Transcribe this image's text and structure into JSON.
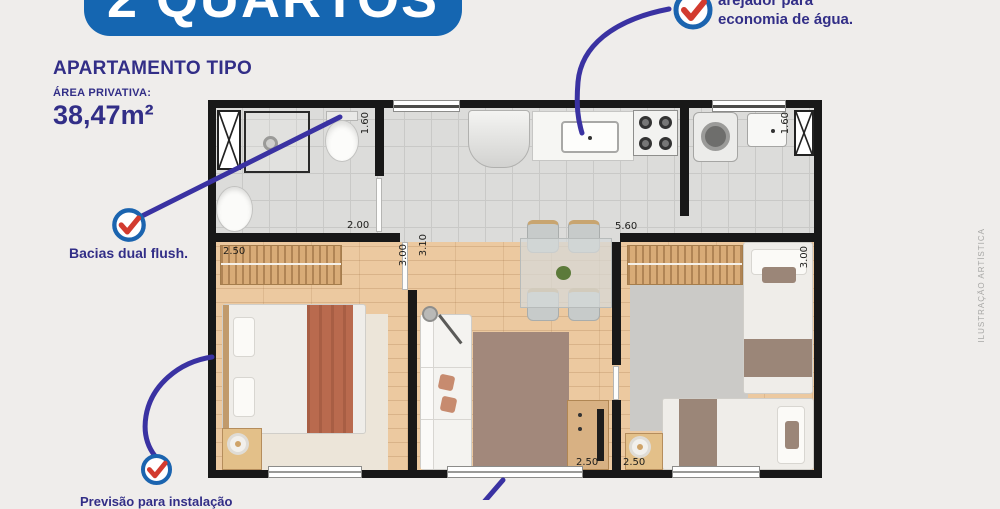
{
  "colors": {
    "brand_blue": "#1566b1",
    "text_indigo": "#322e87",
    "line_indigo": "#3a32a2",
    "check_red": "#d23b2f",
    "wall": "#181818",
    "bg": "#efedeb"
  },
  "banner": {
    "title": "2 QUARTOS"
  },
  "header": {
    "title": "APARTAMENTO TIPO",
    "area_label": "ÁREA PRIVATIVA:",
    "area_value": "38,47m²"
  },
  "callouts": {
    "water": {
      "line1": "arejador para",
      "line2": "economia de água."
    },
    "toilet": {
      "text": "Bacias dual flush."
    },
    "bottom": {
      "text": "Previsão para instalação"
    }
  },
  "watermark": {
    "text": "ILUSTRAÇÃO ARTÍSTICA"
  },
  "floorplan": {
    "dimensions": {
      "bathroom_width": "1.60",
      "bathroom_length": "2.00",
      "bedroom1_width": "2.50",
      "bedroom1_length": "3.00",
      "hall_width": "3.10",
      "kitchen_length": "5.60",
      "laundry_width": "1.60",
      "bedroom2_length": "3.00",
      "living_width": "2.50",
      "bedroom2_width": "2.50"
    }
  }
}
